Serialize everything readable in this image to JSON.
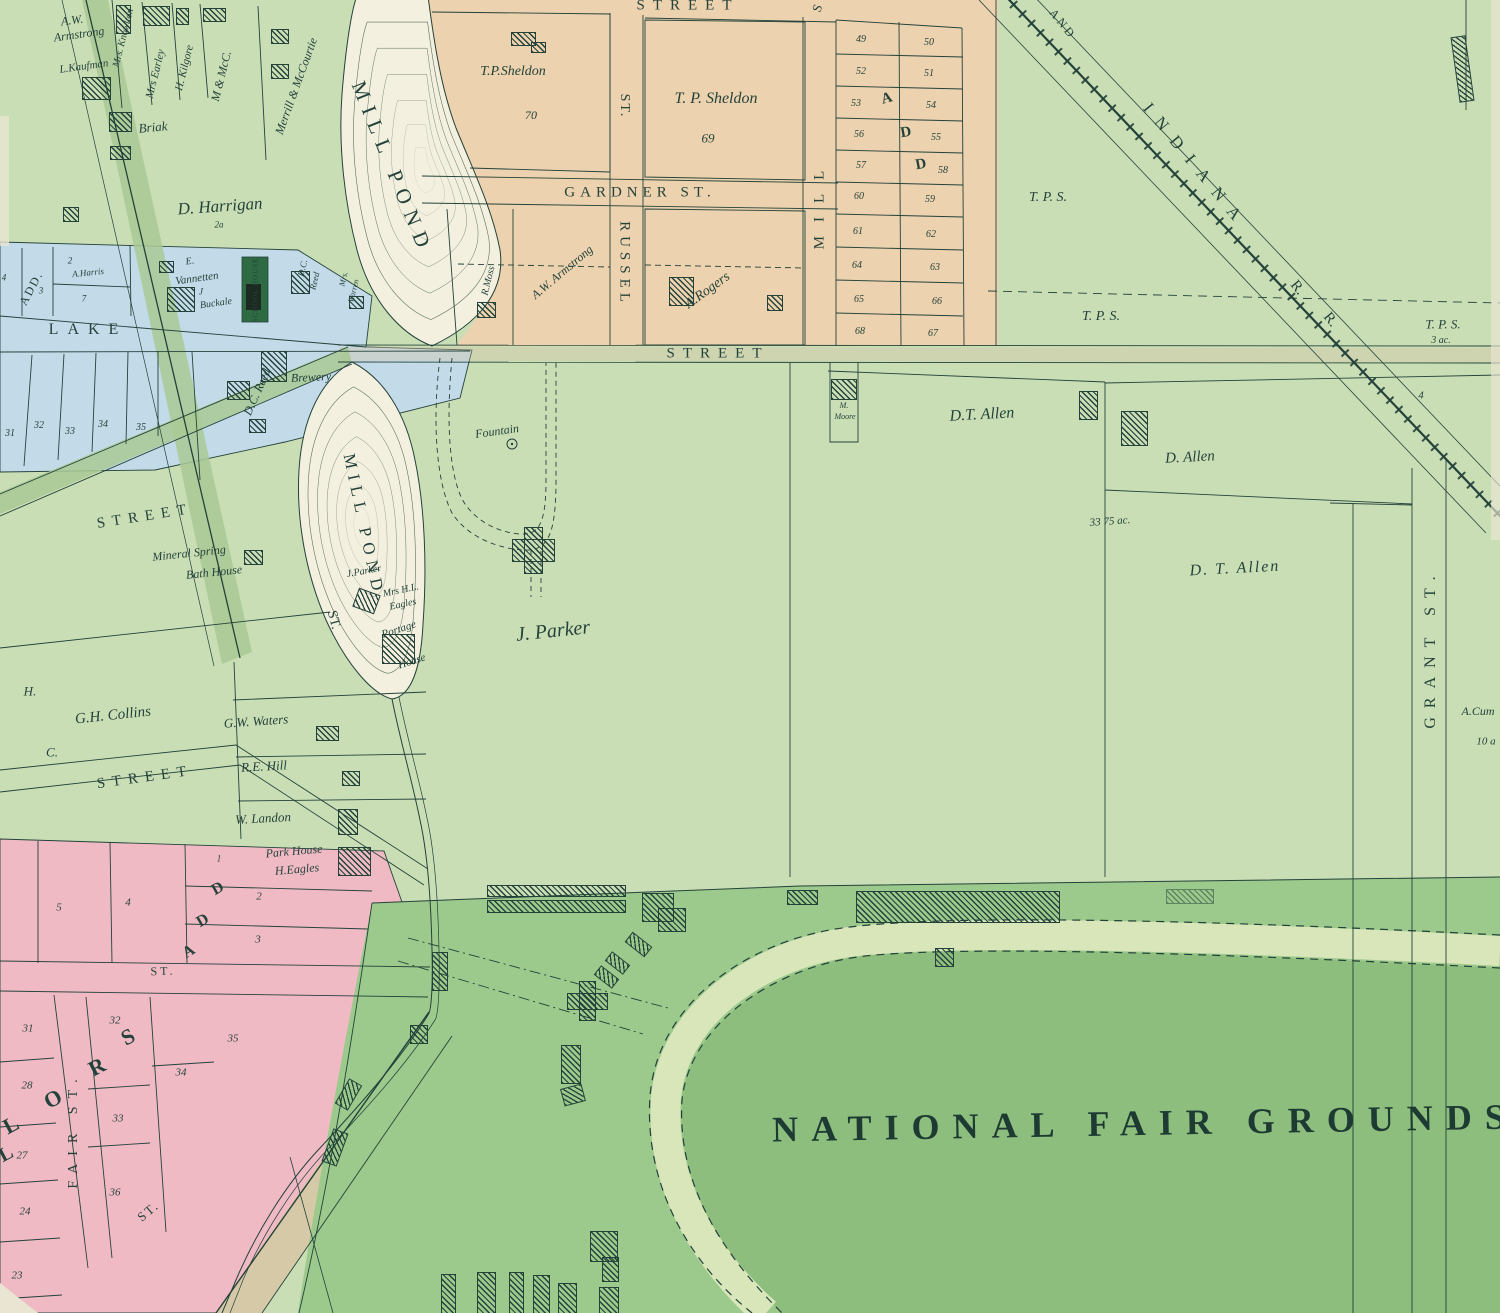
{
  "map_title": "NATIONAL FAIR GROUNDS",
  "colors": {
    "base": "#cadeb6",
    "road": "#a9c994",
    "fair": "#9cc98c",
    "infield": "#8dbe7d",
    "track": "#d8e6ba",
    "orange": "#ecd2ae",
    "pink": "#f0bac5",
    "blue": "#c3dbe9",
    "pond": "#f3f0df",
    "tan": "#d8c3a4",
    "ink": "#24423a",
    "school": "#2e6b43",
    "cream": "#e9e5d2"
  },
  "labels": [
    {
      "t": "A.W.",
      "x": 72,
      "y": 20,
      "s": 12,
      "cls": "i",
      "r": -8
    },
    {
      "t": "Armstrong",
      "x": 79,
      "y": 34,
      "s": 12,
      "cls": "i",
      "r": -8
    },
    {
      "t": "L.Kaufman",
      "x": 84,
      "y": 67,
      "s": 11,
      "cls": "i",
      "r": -8
    },
    {
      "t": "Mrs. Knowlton",
      "x": 124,
      "y": 38,
      "s": 10,
      "cls": "i",
      "r": -76
    },
    {
      "t": "Mrs Earley",
      "x": 156,
      "y": 74,
      "s": 11,
      "cls": "i",
      "r": -76
    },
    {
      "t": "H. Kilgore",
      "x": 185,
      "y": 68,
      "s": 11,
      "cls": "i",
      "r": -76
    },
    {
      "t": "M & McC.",
      "x": 221,
      "y": 76,
      "s": 12,
      "cls": "i",
      "r": -76
    },
    {
      "t": "Merrill & McCourtie",
      "x": 296,
      "y": 86,
      "s": 12,
      "cls": "i",
      "r": -70
    },
    {
      "t": "Briak",
      "x": 153,
      "y": 127,
      "s": 13,
      "cls": "i",
      "r": -5
    },
    {
      "t": "D. Harrigan",
      "x": 220,
      "y": 206,
      "s": 17,
      "cls": "i",
      "r": -4
    },
    {
      "t": "2a",
      "x": 219,
      "y": 225,
      "s": 9,
      "cls": "i"
    },
    {
      "t": "MILL POND",
      "x": 392,
      "y": 168,
      "s": 21,
      "cls": "c",
      "r": 68,
      "ls": 8
    },
    {
      "t": "MILL POND",
      "x": 364,
      "y": 525,
      "s": 17,
      "cls": "c",
      "r": 78,
      "ls": 6
    },
    {
      "t": "STREET",
      "x": 688,
      "y": 6,
      "s": 15,
      "cls": "c",
      "ls": 8
    },
    {
      "t": "S",
      "x": 817,
      "y": 8,
      "s": 13,
      "cls": "c",
      "r": -70
    },
    {
      "t": "T.P.Sheldon",
      "x": 513,
      "y": 72,
      "s": 14,
      "cls": "i"
    },
    {
      "t": "70",
      "x": 531,
      "y": 115,
      "s": 12,
      "cls": "i"
    },
    {
      "t": "T. P. Sheldon",
      "x": 716,
      "y": 99,
      "s": 16,
      "cls": "i"
    },
    {
      "t": "69",
      "x": 708,
      "y": 138,
      "s": 13,
      "cls": "i"
    },
    {
      "t": "GARDNER ST.",
      "x": 640,
      "y": 193,
      "s": 15,
      "cls": "c",
      "ls": 5
    },
    {
      "t": "ST.",
      "x": 624,
      "y": 106,
      "s": 14,
      "cls": "c",
      "r": 90,
      "ls": 2
    },
    {
      "t": "RUSSEL",
      "x": 624,
      "y": 264,
      "s": 15,
      "cls": "c",
      "r": 90,
      "ls": 5
    },
    {
      "t": "MILL",
      "x": 820,
      "y": 203,
      "s": 15,
      "cls": "c",
      "r": -90,
      "ls": 14
    },
    {
      "t": "R.Moss",
      "x": 489,
      "y": 281,
      "s": 10,
      "cls": "i",
      "r": -76
    },
    {
      "t": "A.W. Armstrong",
      "x": 562,
      "y": 272,
      "s": 12,
      "cls": "i",
      "r": -40
    },
    {
      "t": "A.Rogers",
      "x": 708,
      "y": 291,
      "s": 14,
      "cls": "i",
      "r": -36
    },
    {
      "t": "49",
      "x": 861,
      "y": 40,
      "s": 10,
      "cls": "i"
    },
    {
      "t": "50",
      "x": 929,
      "y": 43,
      "s": 10,
      "cls": "i"
    },
    {
      "t": "52",
      "x": 861,
      "y": 72,
      "s": 10,
      "cls": "i"
    },
    {
      "t": "51",
      "x": 929,
      "y": 74,
      "s": 10,
      "cls": "i"
    },
    {
      "t": "53",
      "x": 856,
      "y": 104,
      "s": 10,
      "cls": "i"
    },
    {
      "t": "54",
      "x": 931,
      "y": 106,
      "s": 10,
      "cls": "i"
    },
    {
      "t": "56",
      "x": 859,
      "y": 135,
      "s": 10,
      "cls": "i"
    },
    {
      "t": "55",
      "x": 936,
      "y": 138,
      "s": 10,
      "cls": "i"
    },
    {
      "t": "57",
      "x": 861,
      "y": 166,
      "s": 10,
      "cls": "i"
    },
    {
      "t": "58",
      "x": 943,
      "y": 171,
      "s": 10,
      "cls": "i"
    },
    {
      "t": "60",
      "x": 859,
      "y": 197,
      "s": 10,
      "cls": "i"
    },
    {
      "t": "59",
      "x": 930,
      "y": 200,
      "s": 10,
      "cls": "i"
    },
    {
      "t": "61",
      "x": 858,
      "y": 232,
      "s": 10,
      "cls": "i"
    },
    {
      "t": "62",
      "x": 931,
      "y": 235,
      "s": 10,
      "cls": "i"
    },
    {
      "t": "64",
      "x": 857,
      "y": 266,
      "s": 10,
      "cls": "i"
    },
    {
      "t": "63",
      "x": 935,
      "y": 268,
      "s": 10,
      "cls": "i"
    },
    {
      "t": "65",
      "x": 859,
      "y": 300,
      "s": 10,
      "cls": "i"
    },
    {
      "t": "66",
      "x": 937,
      "y": 302,
      "s": 10,
      "cls": "i"
    },
    {
      "t": "68",
      "x": 860,
      "y": 332,
      "s": 10,
      "cls": "i"
    },
    {
      "t": "67",
      "x": 933,
      "y": 334,
      "s": 10,
      "cls": "i"
    },
    {
      "t": "A",
      "x": 887,
      "y": 99,
      "s": 15,
      "cls": "s",
      "r": -15
    },
    {
      "t": "D",
      "x": 906,
      "y": 133,
      "s": 15,
      "cls": "s",
      "r": -10
    },
    {
      "t": "D",
      "x": 921,
      "y": 165,
      "s": 15,
      "cls": "s",
      "r": -10
    },
    {
      "t": "AND",
      "x": 1063,
      "y": 24,
      "s": 12,
      "cls": "c",
      "r": 51,
      "ls": 3
    },
    {
      "t": "INDIANA",
      "x": 1196,
      "y": 166,
      "s": 17,
      "cls": "c",
      "r": 51,
      "ls": 12
    },
    {
      "t": "R.",
      "x": 1297,
      "y": 288,
      "s": 15,
      "cls": "c",
      "r": 51
    },
    {
      "t": "R.",
      "x": 1330,
      "y": 320,
      "s": 15,
      "cls": "c",
      "r": 51
    },
    {
      "t": "T. P. S.",
      "x": 1048,
      "y": 198,
      "s": 14,
      "cls": "i"
    },
    {
      "t": "T. P. S.",
      "x": 1101,
      "y": 317,
      "s": 14,
      "cls": "i"
    },
    {
      "t": "T. P. S.",
      "x": 1443,
      "y": 324,
      "s": 13,
      "cls": "i"
    },
    {
      "t": "3 ac.",
      "x": 1441,
      "y": 341,
      "s": 10,
      "cls": "i"
    },
    {
      "t": "4",
      "x": 1421,
      "y": 396,
      "s": 11,
      "cls": "i"
    },
    {
      "t": "GRANT ST.",
      "x": 1431,
      "y": 648,
      "s": 16,
      "cls": "c",
      "r": -90,
      "ls": 9
    },
    {
      "t": "A.Cum",
      "x": 1478,
      "y": 711,
      "s": 12,
      "cls": "i"
    },
    {
      "t": "10 a",
      "x": 1486,
      "y": 742,
      "s": 11,
      "cls": "i"
    },
    {
      "t": "STREET",
      "x": 718,
      "y": 354,
      "s": 15,
      "cls": "c",
      "ls": 8
    },
    {
      "t": "M.",
      "x": 844,
      "y": 406,
      "s": 8,
      "cls": "i"
    },
    {
      "t": "Moore",
      "x": 845,
      "y": 417,
      "s": 8,
      "cls": "i"
    },
    {
      "t": "D.T. Allen",
      "x": 982,
      "y": 415,
      "s": 16,
      "cls": "i",
      "r": -3
    },
    {
      "t": "D. Allen",
      "x": 1190,
      "y": 458,
      "s": 15,
      "cls": "i",
      "r": -3
    },
    {
      "t": "33 75 ac.",
      "x": 1110,
      "y": 522,
      "s": 11,
      "cls": "i",
      "r": -4
    },
    {
      "t": "D. T. Allen",
      "x": 1235,
      "y": 569,
      "s": 16,
      "cls": "i",
      "r": -3,
      "ls": 2
    },
    {
      "t": "Fountain",
      "x": 497,
      "y": 431,
      "s": 12,
      "cls": "i",
      "r": -8
    },
    {
      "t": "J. Parker",
      "x": 553,
      "y": 631,
      "s": 20,
      "cls": "i",
      "r": -6
    },
    {
      "t": "ADD.",
      "x": 31,
      "y": 288,
      "s": 12,
      "cls": "c",
      "r": -62,
      "ls": 2
    },
    {
      "t": "4",
      "x": 4,
      "y": 278,
      "s": 9,
      "cls": "i"
    },
    {
      "t": "2",
      "x": 70,
      "y": 261,
      "s": 9,
      "cls": "i"
    },
    {
      "t": "A.Harris",
      "x": 88,
      "y": 273,
      "s": 9,
      "cls": "i",
      "r": -6
    },
    {
      "t": "3",
      "x": 41,
      "y": 291,
      "s": 9,
      "cls": "i"
    },
    {
      "t": "7",
      "x": 84,
      "y": 299,
      "s": 9,
      "cls": "i"
    },
    {
      "t": "LAKE",
      "x": 88,
      "y": 330,
      "s": 16,
      "cls": "c",
      "ls": 9
    },
    {
      "t": "31",
      "x": 10,
      "y": 434,
      "s": 10,
      "cls": "i"
    },
    {
      "t": "32",
      "x": 39,
      "y": 426,
      "s": 10,
      "cls": "i"
    },
    {
      "t": "33",
      "x": 70,
      "y": 432,
      "s": 10,
      "cls": "i"
    },
    {
      "t": "34",
      "x": 103,
      "y": 425,
      "s": 10,
      "cls": "i"
    },
    {
      "t": "35",
      "x": 141,
      "y": 428,
      "s": 10,
      "cls": "i"
    },
    {
      "t": "E.",
      "x": 190,
      "y": 262,
      "s": 10,
      "cls": "i",
      "r": -8
    },
    {
      "t": "Vannetten",
      "x": 197,
      "y": 279,
      "s": 11,
      "cls": "i",
      "r": -8
    },
    {
      "t": "J",
      "x": 201,
      "y": 292,
      "s": 9,
      "cls": "i"
    },
    {
      "t": "Buckale",
      "x": 216,
      "y": 304,
      "s": 10,
      "cls": "i",
      "r": -8
    },
    {
      "t": "SCHOOL HOUSE",
      "x": 256,
      "y": 290,
      "s": 7,
      "cls": "c",
      "r": -90,
      "ls": 1
    },
    {
      "t": "D.C.",
      "x": 303,
      "y": 268,
      "s": 9,
      "cls": "i",
      "r": -76
    },
    {
      "t": "Reed",
      "x": 315,
      "y": 281,
      "s": 9,
      "cls": "i",
      "r": -76
    },
    {
      "t": "Mrs.",
      "x": 344,
      "y": 279,
      "s": 8,
      "cls": "i",
      "r": -76
    },
    {
      "t": "Warren",
      "x": 354,
      "y": 291,
      "s": 8,
      "cls": "i",
      "r": -76
    },
    {
      "t": "Brewery",
      "x": 311,
      "y": 377,
      "s": 12,
      "cls": "i",
      "r": -3
    },
    {
      "t": "D.C. Reed",
      "x": 257,
      "y": 392,
      "s": 12,
      "cls": "i",
      "r": -66
    },
    {
      "t": "G.H. Collins",
      "x": 113,
      "y": 716,
      "s": 15,
      "cls": "i",
      "r": -6
    },
    {
      "t": "STREET",
      "x": 145,
      "y": 517,
      "s": 15,
      "cls": "c",
      "r": -9,
      "ls": 7
    },
    {
      "t": "STREET",
      "x": 145,
      "y": 778,
      "s": 15,
      "cls": "c",
      "r": -8,
      "ls": 7
    },
    {
      "t": "H.",
      "x": 30,
      "y": 691,
      "s": 13,
      "cls": "i"
    },
    {
      "t": "C.",
      "x": 52,
      "y": 752,
      "s": 13,
      "cls": "i"
    },
    {
      "t": "Mineral Spring",
      "x": 189,
      "y": 553,
      "s": 12,
      "cls": "i",
      "r": -6
    },
    {
      "t": "Bath House",
      "x": 214,
      "y": 572,
      "s": 12,
      "cls": "i",
      "r": -6
    },
    {
      "t": "ST.",
      "x": 333,
      "y": 620,
      "s": 14,
      "cls": "c",
      "r": 75
    },
    {
      "t": "J.Parker",
      "x": 364,
      "y": 572,
      "s": 10,
      "cls": "i",
      "r": -10
    },
    {
      "t": "Mrs H.L.",
      "x": 401,
      "y": 591,
      "s": 10,
      "cls": "i",
      "r": -12
    },
    {
      "t": "Eagles",
      "x": 403,
      "y": 605,
      "s": 10,
      "cls": "i",
      "r": -12
    },
    {
      "t": "Portage",
      "x": 399,
      "y": 630,
      "s": 11,
      "cls": "i",
      "r": -18
    },
    {
      "t": "House",
      "x": 412,
      "y": 662,
      "s": 11,
      "cls": "i",
      "r": -18
    },
    {
      "t": "G.W. Waters",
      "x": 256,
      "y": 721,
      "s": 13,
      "cls": "i",
      "r": -4
    },
    {
      "t": "R.E. Hill",
      "x": 264,
      "y": 766,
      "s": 13,
      "cls": "i",
      "r": -3
    },
    {
      "t": "W. Landon",
      "x": 263,
      "y": 818,
      "s": 13,
      "cls": "i",
      "r": -3
    },
    {
      "t": "Park House",
      "x": 294,
      "y": 851,
      "s": 12,
      "cls": "i",
      "r": -5
    },
    {
      "t": "H.Eagles",
      "x": 297,
      "y": 869,
      "s": 12,
      "cls": "i",
      "r": -5
    },
    {
      "t": "1",
      "x": 219,
      "y": 859,
      "s": 9,
      "cls": "i"
    },
    {
      "t": "5",
      "x": 59,
      "y": 908,
      "s": 11,
      "cls": "i"
    },
    {
      "t": "4",
      "x": 128,
      "y": 903,
      "s": 11,
      "cls": "i"
    },
    {
      "t": "2",
      "x": 259,
      "y": 897,
      "s": 11,
      "cls": "i"
    },
    {
      "t": "3",
      "x": 258,
      "y": 940,
      "s": 11,
      "cls": "i"
    },
    {
      "t": "ST.",
      "x": 163,
      "y": 971,
      "s": 12,
      "cls": "c",
      "r": -2,
      "ls": 3
    },
    {
      "t": "D",
      "x": 218,
      "y": 889,
      "s": 16,
      "cls": "s",
      "r": -30
    },
    {
      "t": "D",
      "x": 203,
      "y": 921,
      "s": 16,
      "cls": "s",
      "r": -30
    },
    {
      "t": "A",
      "x": 189,
      "y": 952,
      "s": 16,
      "cls": "s",
      "r": -30
    },
    {
      "t": "31",
      "x": 28,
      "y": 1029,
      "s": 11,
      "cls": "i"
    },
    {
      "t": "32",
      "x": 115,
      "y": 1021,
      "s": 11,
      "cls": "i"
    },
    {
      "t": "35",
      "x": 233,
      "y": 1039,
      "s": 11,
      "cls": "i"
    },
    {
      "t": "28",
      "x": 27,
      "y": 1086,
      "s": 11,
      "cls": "i"
    },
    {
      "t": "34",
      "x": 181,
      "y": 1073,
      "s": 11,
      "cls": "i"
    },
    {
      "t": "33",
      "x": 118,
      "y": 1119,
      "s": 11,
      "cls": "i"
    },
    {
      "t": "27",
      "x": 22,
      "y": 1156,
      "s": 11,
      "cls": "i"
    },
    {
      "t": "24",
      "x": 25,
      "y": 1212,
      "s": 11,
      "cls": "i"
    },
    {
      "t": "36",
      "x": 115,
      "y": 1193,
      "s": 11,
      "cls": "i"
    },
    {
      "t": "23",
      "x": 17,
      "y": 1276,
      "s": 11,
      "cls": "i"
    },
    {
      "t": "S",
      "x": 128,
      "y": 1037,
      "s": 22,
      "cls": "s",
      "r": -28
    },
    {
      "t": "R",
      "x": 97,
      "y": 1067,
      "s": 22,
      "cls": "s",
      "r": -28
    },
    {
      "t": "O",
      "x": 53,
      "y": 1099,
      "s": 22,
      "cls": "s",
      "r": -28
    },
    {
      "t": "L",
      "x": 11,
      "y": 1125,
      "s": 22,
      "cls": "s",
      "r": -28
    },
    {
      "t": "L",
      "x": 6,
      "y": 1154,
      "s": 20,
      "cls": "s",
      "r": -28
    },
    {
      "t": "FAIR ST.",
      "x": 74,
      "y": 1130,
      "s": 14,
      "cls": "c",
      "r": -90,
      "ls": 8
    },
    {
      "t": "ST.",
      "x": 148,
      "y": 1211,
      "s": 13,
      "cls": "c",
      "r": -40,
      "ls": 2
    },
    {
      "t": "NATIONAL FAIR GROUNDS",
      "x": 1145,
      "y": 1123,
      "s": 36,
      "cls": "t",
      "ls": 13,
      "r": -1
    }
  ],
  "buildings": [
    {
      "x": 143,
      "y": 6,
      "w": 25,
      "h": 18
    },
    {
      "x": 116,
      "y": 5,
      "w": 13,
      "h": 27
    },
    {
      "x": 176,
      "y": 8,
      "w": 11,
      "h": 15
    },
    {
      "x": 203,
      "y": 8,
      "w": 21,
      "h": 12
    },
    {
      "x": 271,
      "y": 29,
      "w": 16,
      "h": 13
    },
    {
      "x": 271,
      "y": 64,
      "w": 16,
      "h": 13
    },
    {
      "x": 82,
      "y": 77,
      "w": 27,
      "h": 21
    },
    {
      "x": 109,
      "y": 112,
      "w": 21,
      "h": 18
    },
    {
      "x": 110,
      "y": 146,
      "w": 19,
      "h": 12
    },
    {
      "x": 63,
      "y": 207,
      "w": 14,
      "h": 13
    },
    {
      "x": 511,
      "y": 32,
      "w": 23,
      "h": 12
    },
    {
      "x": 531,
      "y": 42,
      "w": 13,
      "h": 9
    },
    {
      "x": 159,
      "y": 261,
      "w": 13,
      "h": 10
    },
    {
      "x": 167,
      "y": 287,
      "w": 26,
      "h": 23
    },
    {
      "x": 291,
      "y": 271,
      "w": 17,
      "h": 21
    },
    {
      "x": 349,
      "y": 296,
      "w": 13,
      "h": 11
    },
    {
      "x": 477,
      "y": 302,
      "w": 17,
      "h": 14
    },
    {
      "x": 669,
      "y": 277,
      "w": 23,
      "h": 27
    },
    {
      "x": 767,
      "y": 295,
      "w": 14,
      "h": 14
    },
    {
      "x": 261,
      "y": 351,
      "w": 24,
      "h": 29
    },
    {
      "x": 227,
      "y": 381,
      "w": 21,
      "h": 17
    },
    {
      "x": 249,
      "y": 419,
      "w": 15,
      "h": 12
    },
    {
      "x": 831,
      "y": 379,
      "w": 24,
      "h": 19
    },
    {
      "x": 1079,
      "y": 391,
      "w": 17,
      "h": 27
    },
    {
      "x": 1121,
      "y": 411,
      "w": 25,
      "h": 33
    },
    {
      "x": 244,
      "y": 550,
      "w": 17,
      "h": 13
    },
    {
      "x": 355,
      "y": 591,
      "w": 21,
      "h": 18,
      "r": 20
    },
    {
      "x": 382,
      "y": 634,
      "w": 31,
      "h": 28
    },
    {
      "x": 316,
      "y": 726,
      "w": 21,
      "h": 13
    },
    {
      "x": 342,
      "y": 771,
      "w": 16,
      "h": 13
    },
    {
      "x": 338,
      "y": 809,
      "w": 18,
      "h": 24
    },
    {
      "x": 338,
      "y": 847,
      "w": 31,
      "h": 27
    },
    {
      "x": 512,
      "y": 539,
      "w": 41,
      "h": 21
    },
    {
      "x": 524,
      "y": 527,
      "w": 17,
      "h": 45
    },
    {
      "x": 487,
      "y": 885,
      "w": 137,
      "h": 10
    },
    {
      "x": 487,
      "y": 900,
      "w": 137,
      "h": 11
    },
    {
      "x": 642,
      "y": 893,
      "w": 30,
      "h": 27
    },
    {
      "x": 658,
      "y": 908,
      "w": 26,
      "h": 22
    },
    {
      "x": 626,
      "y": 938,
      "w": 23,
      "h": 11,
      "r": 38
    },
    {
      "x": 606,
      "y": 957,
      "w": 21,
      "h": 10,
      "r": 38
    },
    {
      "x": 595,
      "y": 971,
      "w": 21,
      "h": 10,
      "r": 38
    },
    {
      "x": 567,
      "y": 993,
      "w": 39,
      "h": 15
    },
    {
      "x": 579,
      "y": 981,
      "w": 15,
      "h": 38
    },
    {
      "x": 432,
      "y": 952,
      "w": 14,
      "h": 37
    },
    {
      "x": 410,
      "y": 1025,
      "w": 16,
      "h": 17
    },
    {
      "x": 561,
      "y": 1045,
      "w": 18,
      "h": 37
    },
    {
      "x": 562,
      "y": 1086,
      "w": 20,
      "h": 16,
      "r": -15
    },
    {
      "x": 856,
      "y": 891,
      "w": 202,
      "h": 30
    },
    {
      "x": 787,
      "y": 890,
      "w": 29,
      "h": 13
    },
    {
      "x": 935,
      "y": 948,
      "w": 17,
      "h": 17
    },
    {
      "x": 1166,
      "y": 889,
      "w": 46,
      "h": 13,
      "light": true
    },
    {
      "x": 590,
      "y": 1231,
      "w": 26,
      "h": 29
    },
    {
      "x": 602,
      "y": 1257,
      "w": 15,
      "h": 23
    },
    {
      "x": 599,
      "y": 1287,
      "w": 18,
      "h": 26
    },
    {
      "x": 441,
      "y": 1274,
      "w": 13,
      "h": 39
    },
    {
      "x": 477,
      "y": 1272,
      "w": 17,
      "h": 41
    },
    {
      "x": 509,
      "y": 1272,
      "w": 13,
      "h": 41
    },
    {
      "x": 533,
      "y": 1275,
      "w": 15,
      "h": 38
    },
    {
      "x": 558,
      "y": 1283,
      "w": 17,
      "h": 30
    },
    {
      "x": 327,
      "y": 1130,
      "w": 14,
      "h": 33,
      "r": 20
    },
    {
      "x": 341,
      "y": 1080,
      "w": 13,
      "h": 27,
      "r": 30
    },
    {
      "x": 1455,
      "y": 36,
      "w": 13,
      "h": 64,
      "r": -8
    }
  ]
}
